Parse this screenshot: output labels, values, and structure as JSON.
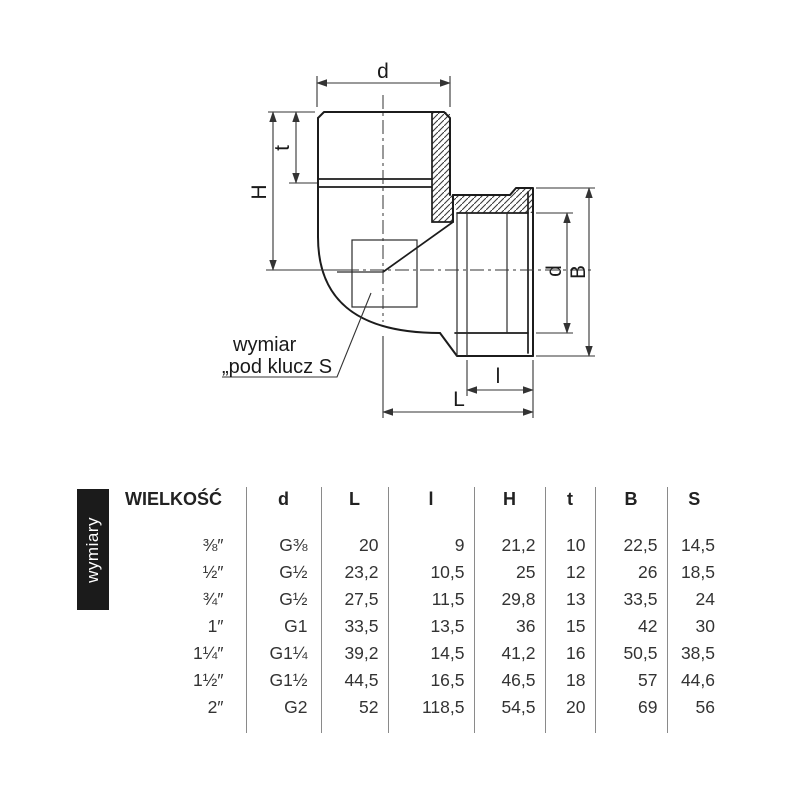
{
  "section_label": "wymiary",
  "drawing": {
    "labels": {
      "d_top": "d",
      "t": "t",
      "H": "H",
      "d_right": "d",
      "B": "B",
      "l": "l",
      "L": "L"
    },
    "note": {
      "line1": "wymiar",
      "line2": "„pod klucz S"
    }
  },
  "table": {
    "headers": [
      "WIELKOŚĆ",
      "d",
      "L",
      "l",
      "H",
      "t",
      "B",
      "S"
    ],
    "rows": [
      [
        "⅜″",
        "G⅜",
        "20",
        "9",
        "21,2",
        "10",
        "22,5",
        "14,5"
      ],
      [
        "½″",
        "G½",
        "23,2",
        "10,5",
        "25",
        "12",
        "26",
        "18,5"
      ],
      [
        "¾″",
        "G½",
        "27,5",
        "11,5",
        "29,8",
        "13",
        "33,5",
        "24"
      ],
      [
        "1″",
        "G1",
        "33,5",
        "13,5",
        "36",
        "15",
        "42",
        "30"
      ],
      [
        "1¼″",
        "G1¼",
        "39,2",
        "14,5",
        "41,2",
        "16",
        "50,5",
        "38,5"
      ],
      [
        "1½″",
        "G1½",
        "44,5",
        "16,5",
        "46,5",
        "18",
        "57",
        "44,6"
      ],
      [
        "2″",
        "G2",
        "52",
        "118,5",
        "54,5",
        "20",
        "69",
        "56"
      ]
    ]
  }
}
